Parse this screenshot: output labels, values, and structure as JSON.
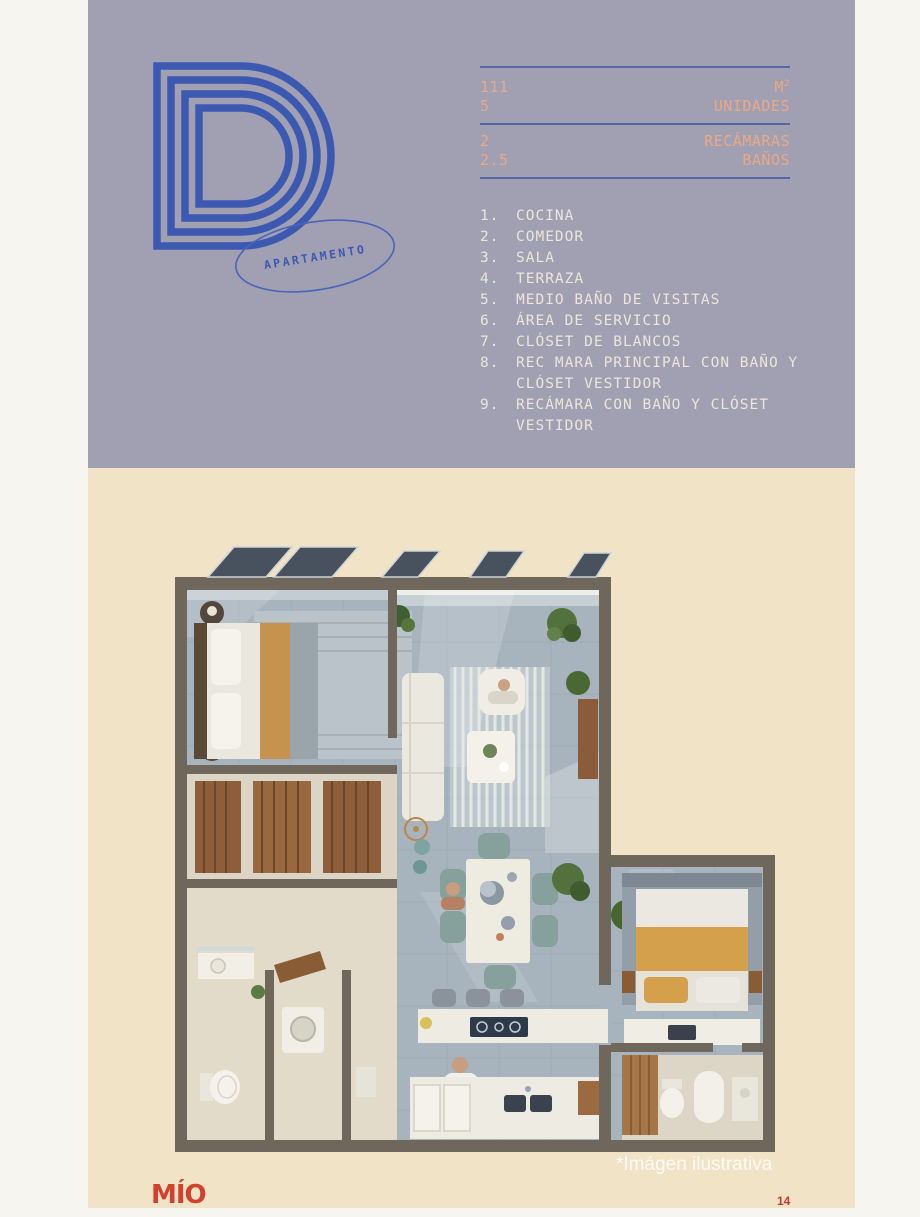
{
  "header": {
    "letter": "D",
    "badge": "APARTAMENTO"
  },
  "stats": {
    "rows": [
      {
        "value": "111",
        "label": "M",
        "sup": "2"
      },
      {
        "value": "5",
        "label": "UNIDADES",
        "sup": ""
      },
      {
        "value": "2",
        "label": "RECÁMARAS",
        "sup": ""
      },
      {
        "value": "2.5",
        "label": "BAÑOS",
        "sup": ""
      }
    ]
  },
  "features": [
    {
      "num": "1.",
      "text": "COCINA"
    },
    {
      "num": "2.",
      "text": "COMEDOR"
    },
    {
      "num": "3.",
      "text": "SALA"
    },
    {
      "num": "4.",
      "text": "TERRAZA"
    },
    {
      "num": "5.",
      "text": "MEDIO BAÑO DE VISITAS"
    },
    {
      "num": "6.",
      "text": "ÁREA DE SERVICIO"
    },
    {
      "num": "7.",
      "text": "CLÓSET DE BLANCOS"
    },
    {
      "num": "8.",
      "text": "REC MARA PRINCIPAL CON BAÑO Y CLÓSET VESTIDOR"
    },
    {
      "num": "9.",
      "text": "RECÁMARA CON BAÑO Y CLÓSET VESTIDOR"
    }
  ],
  "floorplan": {
    "caption": "*Imágen ilustrativa"
  },
  "footer": {
    "logo": "MÍO",
    "page": "14"
  },
  "colors": {
    "panel_purple": "#a19fb2",
    "panel_cream": "#f1e4c6",
    "logo_blue": "#3c59b2",
    "divider_blue": "#5766a8",
    "stat_salmon": "#e9a987",
    "list_white": "#ece6da",
    "brand_red": "#d2402f"
  }
}
